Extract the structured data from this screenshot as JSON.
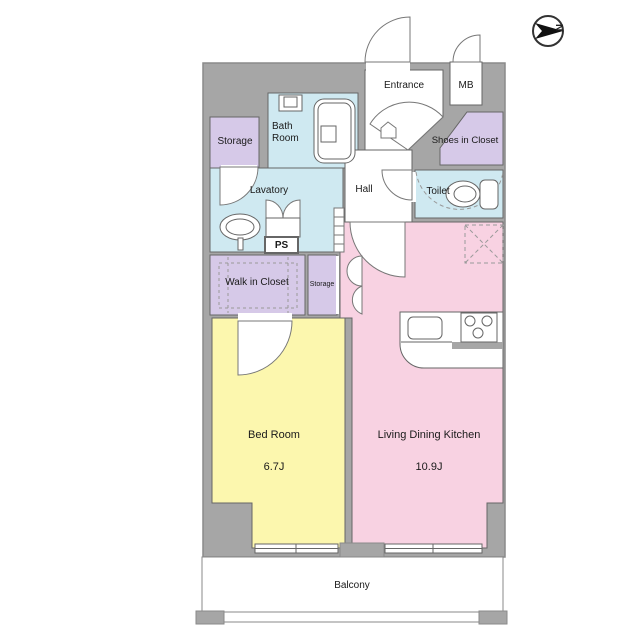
{
  "plan": {
    "compass_label": "N",
    "rooms": {
      "entrance": "Entrance",
      "meter_box": "MB",
      "shoes_in_closet": "Shoes in Closet",
      "storage_upper": "Storage",
      "bath_room": "Bath Room",
      "lavatory": "Lavatory",
      "hall": "Hall",
      "toilet": "Toilet",
      "pipe_space": "PS",
      "walk_in_closet": "Walk in Closet",
      "storage_lower": "Storage",
      "bed_room": "Bed Room",
      "bed_room_area": "6.7J",
      "living_dining_kitchen": "Living Dining Kitchen",
      "living_dining_kitchen_area": "10.9J",
      "balcony": "Balcony"
    },
    "colors": {
      "wall_gray": "#a6a6a6",
      "wet_area_blue": "#cfe9f1",
      "closet_purple": "#d6c9e8",
      "ldk_pink": "#f8d2e2",
      "bedroom_yellow": "#fcf7ae",
      "line": "#666666"
    }
  }
}
